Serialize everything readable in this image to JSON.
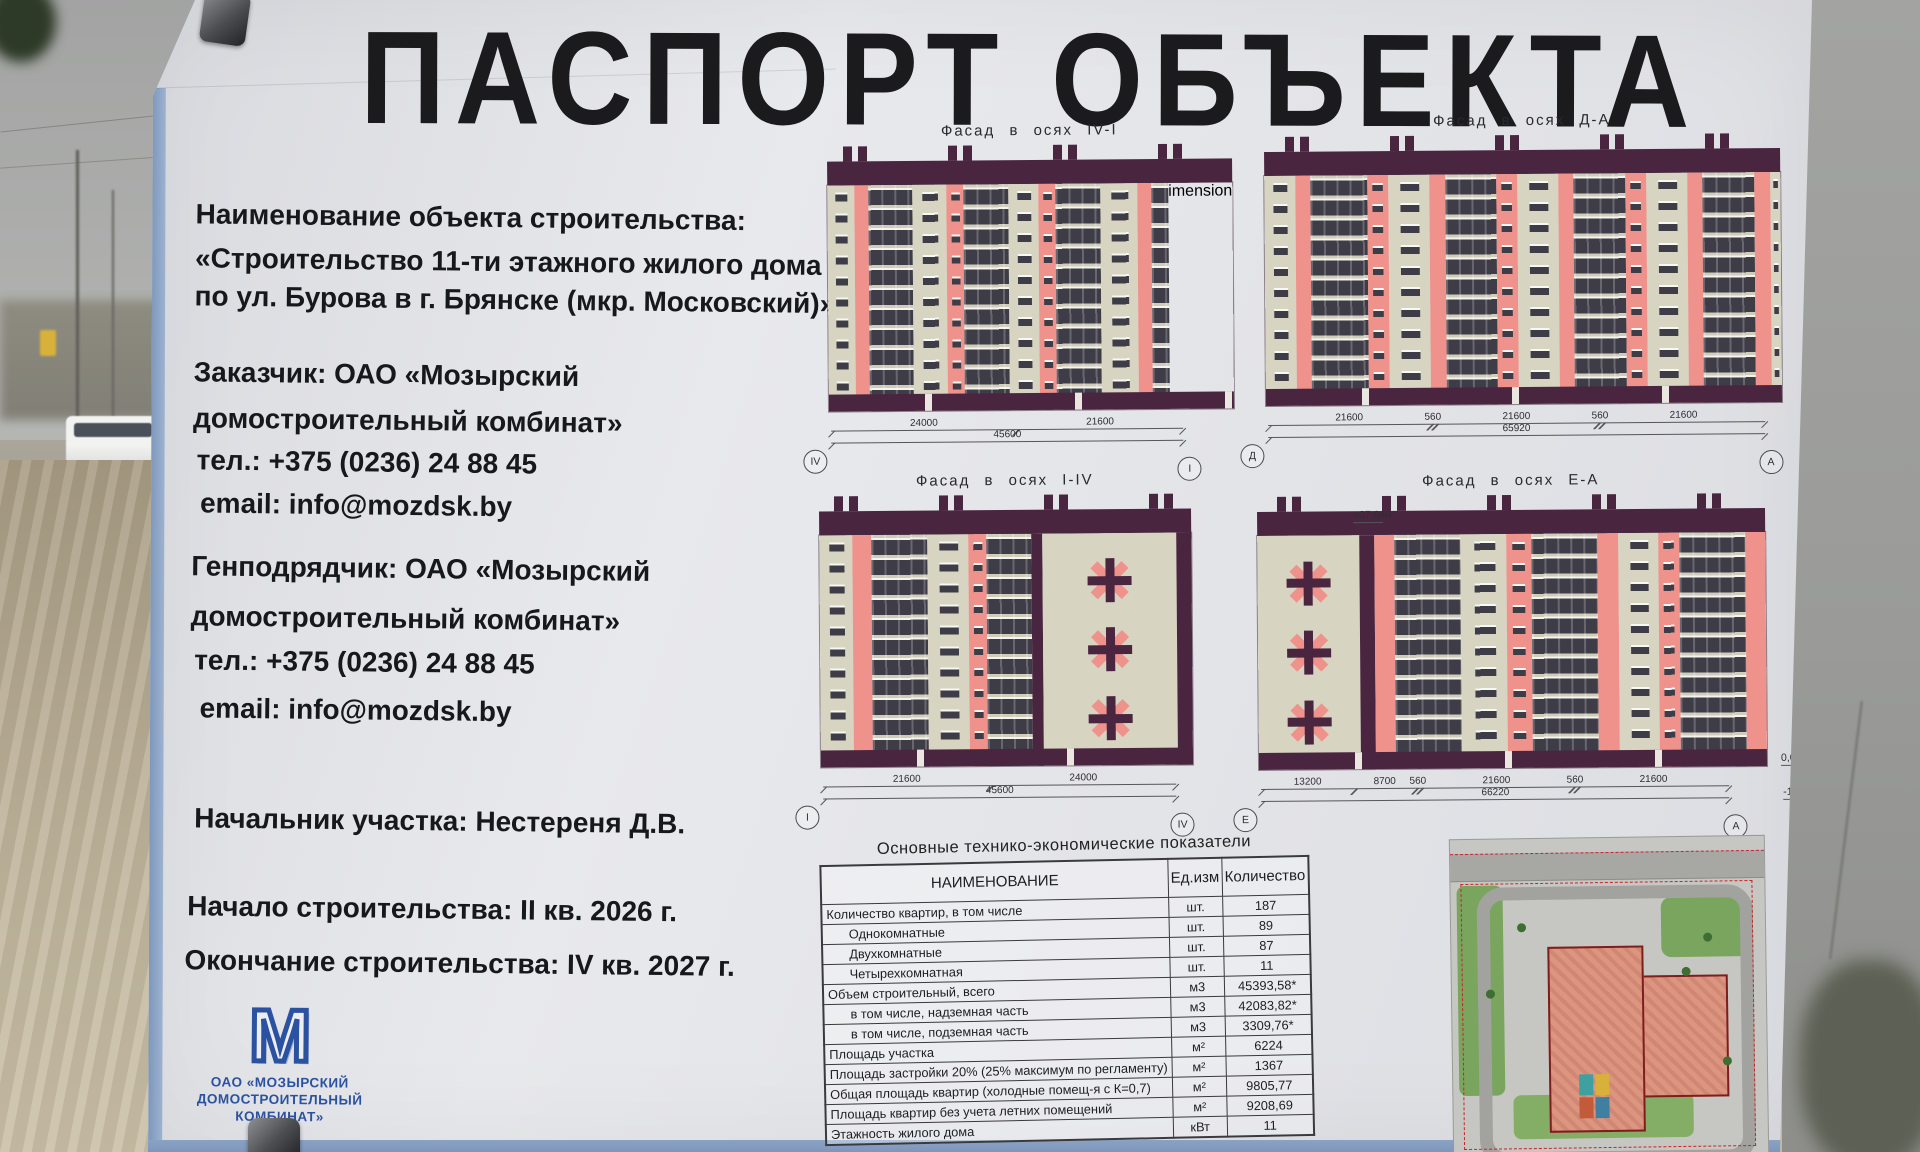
{
  "board": {
    "title": "ПАСПОРТ ОБЪЕКТА",
    "info": {
      "name_label": "Наименование объекта строительства:",
      "name_line1": "«Строительство 11-ти этажного жилого дома",
      "name_line2": "по ул. Бурова в г. Брянске (мкр. Московский)»",
      "customer_line1": "Заказчик: ОАО «Мозырский",
      "customer_line2": "домостроительный комбинат»",
      "customer_phone": "тел.: +375 (0236) 24 88 45",
      "customer_email": "email: info@mozdsk.by",
      "contractor_line1": "Генподрядчик: ОАО «Мозырский",
      "contractor_line2": "домостроительный комбинат»",
      "contractor_phone": "тел.: +375 (0236) 24 88 45",
      "contractor_email": "email: info@mozdsk.by",
      "site_manager": "Начальник участка: Нестереня Д.В.",
      "start": "Начало строительства: II кв. 2026 г.",
      "finish": "Окончание строительства: IV кв. 2027 г."
    },
    "logo": {
      "monogram": "М",
      "line1": "ОАО «МОЗЫРСКИЙ",
      "line2": "ДОМОСТРОИТЕЛЬНЫЙ",
      "line3": "КОМБИНАТ»"
    },
    "facades": [
      {
        "label": "Фасад в осях IV-I",
        "axis_left": "IV",
        "axis_right": "I",
        "dims": [
          "24000",
          "21600"
        ],
        "total": "45600"
      },
      {
        "label": "Фасад в осях Д-А",
        "axis_left": "Д",
        "axis_right": "А",
        "dims": [
          "21600",
          "560",
          "21600",
          "560",
          "21600"
        ],
        "total": "65920"
      },
      {
        "label": "Фасад в осях I-IV",
        "axis_left": "I",
        "axis_right": "IV",
        "dims": [
          "21600",
          "24000"
        ],
        "total": "45600"
      },
      {
        "label": "Фасад в осях Е-А",
        "axis_left": "Е",
        "axis_right": "А",
        "dims": [
          "13200",
          "8700",
          "560",
          "21600",
          "560",
          "21600"
        ],
        "total": "66220",
        "elev_top": "+37,040",
        "elev_zero": "0,000",
        "elev_minus": "-1,000"
      }
    ],
    "table": {
      "title": "Основные технико-экономические показатели",
      "headers": [
        "НАИМЕНОВАНИЕ",
        "Ед.изм",
        "Количество"
      ],
      "rows": [
        {
          "name": "Количество квартир, в том числе",
          "unit": "шт.",
          "value": "187",
          "indent": false
        },
        {
          "name": "Однокомнатные",
          "unit": "шт.",
          "value": "89",
          "indent": true
        },
        {
          "name": "Двухкомнатные",
          "unit": "шт.",
          "value": "87",
          "indent": true
        },
        {
          "name": "Четырехкомнатная",
          "unit": "шт.",
          "value": "11",
          "indent": true
        },
        {
          "name": "Объем строительный, всего",
          "unit": "м3",
          "value": "45393,58*",
          "indent": false
        },
        {
          "name": "в том числе, надземная часть",
          "unit": "м3",
          "value": "42083,82*",
          "indent": true
        },
        {
          "name": "в том числе, подземная часть",
          "unit": "м3",
          "value": "3309,76*",
          "indent": true
        },
        {
          "name": "Площадь участка",
          "unit": "м²",
          "value": "6224",
          "indent": false
        },
        {
          "name": "Площадь застройки 20% (25% максимум по регламенту)",
          "unit": "м²",
          "value": "1367",
          "indent": false
        },
        {
          "name": "Общая площадь квартир (холодные помещ-я с К=0,7)",
          "unit": "м²",
          "value": "9805,77",
          "indent": false
        },
        {
          "name": "Площадь квартир без учета летних помещений",
          "unit": "м²",
          "value": "9208,69",
          "indent": false
        },
        {
          "name": "Этажность жилого дома",
          "unit": "кВт",
          "value": "11",
          "indent": false
        }
      ]
    },
    "colors": {
      "plum": "#4a2540",
      "cream": "#d8d4c2",
      "salmon": "#ef928c",
      "frame_blue": "#8aa2c4",
      "logo_blue": "#2b52a0"
    }
  }
}
